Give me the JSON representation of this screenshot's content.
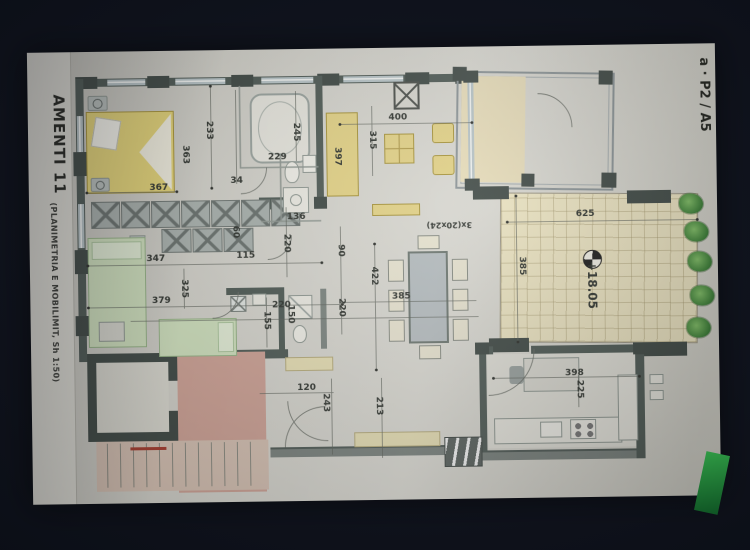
{
  "paper": {
    "strip_title": "AMENTI 11",
    "strip_subtitle": "(PLANIMETRIA E MOBILIMIT, Sh 1:50)",
    "sheet_label": "a · P2 / A5"
  },
  "colors": {
    "paper": "#d6d5cc",
    "wall_dark": "#4e5b55",
    "wall_col": "#3f4a45",
    "window_glass": "#b9c7ca",
    "furn_yellow": "#e7d47e",
    "bed_yellow": "#e8d66e",
    "bed_green": "#cfe2bb",
    "terrace_floor": "#f0e7c0",
    "stair_pink": "#d3a294",
    "plant_green": "#3f9a39",
    "accent_red": "#b03a2a",
    "ink": "#30352f"
  },
  "dim_labels": [
    {
      "t": "367",
      "x": 130,
      "y": 137
    },
    {
      "t": "363",
      "x": 157,
      "y": 104,
      "r": 90
    },
    {
      "t": "233",
      "x": 181,
      "y": 80,
      "r": 90
    },
    {
      "t": "34",
      "x": 208,
      "y": 131
    },
    {
      "t": "229",
      "x": 249,
      "y": 108
    },
    {
      "t": "245",
      "x": 268,
      "y": 83,
      "r": 90
    },
    {
      "t": "397",
      "x": 309,
      "y": 108,
      "r": 90
    },
    {
      "t": "315",
      "x": 344,
      "y": 92,
      "r": 90
    },
    {
      "t": "400",
      "x": 370,
      "y": 70
    },
    {
      "t": "136",
      "x": 267,
      "y": 168
    },
    {
      "t": "60",
      "x": 206,
      "y": 182,
      "r": 90
    },
    {
      "t": "115",
      "x": 216,
      "y": 206
    },
    {
      "t": "220",
      "x": 257,
      "y": 194,
      "r": 90
    },
    {
      "t": "90",
      "x": 311,
      "y": 202,
      "r": 90
    },
    {
      "t": "220",
      "x": 311,
      "y": 259,
      "r": 90
    },
    {
      "t": "347",
      "x": 126,
      "y": 208
    },
    {
      "t": "325",
      "x": 154,
      "y": 238,
      "r": 90
    },
    {
      "t": "379",
      "x": 131,
      "y": 250
    },
    {
      "t": "220",
      "x": 251,
      "y": 256
    },
    {
      "t": "150",
      "x": 260,
      "y": 265,
      "r": 90
    },
    {
      "t": "155",
      "x": 236,
      "y": 271,
      "r": 90
    },
    {
      "t": "120",
      "x": 275,
      "y": 339
    },
    {
      "t": "243",
      "x": 294,
      "y": 354,
      "r": 90
    },
    {
      "t": "213",
      "x": 347,
      "y": 358,
      "r": 90
    },
    {
      "t": "422",
      "x": 344,
      "y": 228,
      "r": 90
    },
    {
      "t": "385",
      "x": 371,
      "y": 249
    },
    {
      "t": "3x(20x24)",
      "x": 420,
      "y": 178,
      "r": 180,
      "s": 8
    },
    {
      "t": "625",
      "x": 556,
      "y": 169
    },
    {
      "t": "385",
      "x": 492,
      "y": 220,
      "r": 90
    },
    {
      "t": "+18.05",
      "x": 562,
      "y": 240,
      "r": 90,
      "s": 12
    },
    {
      "t": "398",
      "x": 543,
      "y": 328
    },
    {
      "t": "225",
      "x": 548,
      "y": 344,
      "r": 90
    }
  ],
  "wardrobe": {
    "row1": {
      "x": 62,
      "y": 150,
      "count": 7,
      "step": 30,
      "w": 29,
      "h": 27
    },
    "row2": {
      "x": 132,
      "y": 178,
      "count": 3,
      "step": 31,
      "w": 30,
      "h": 24
    }
  }
}
